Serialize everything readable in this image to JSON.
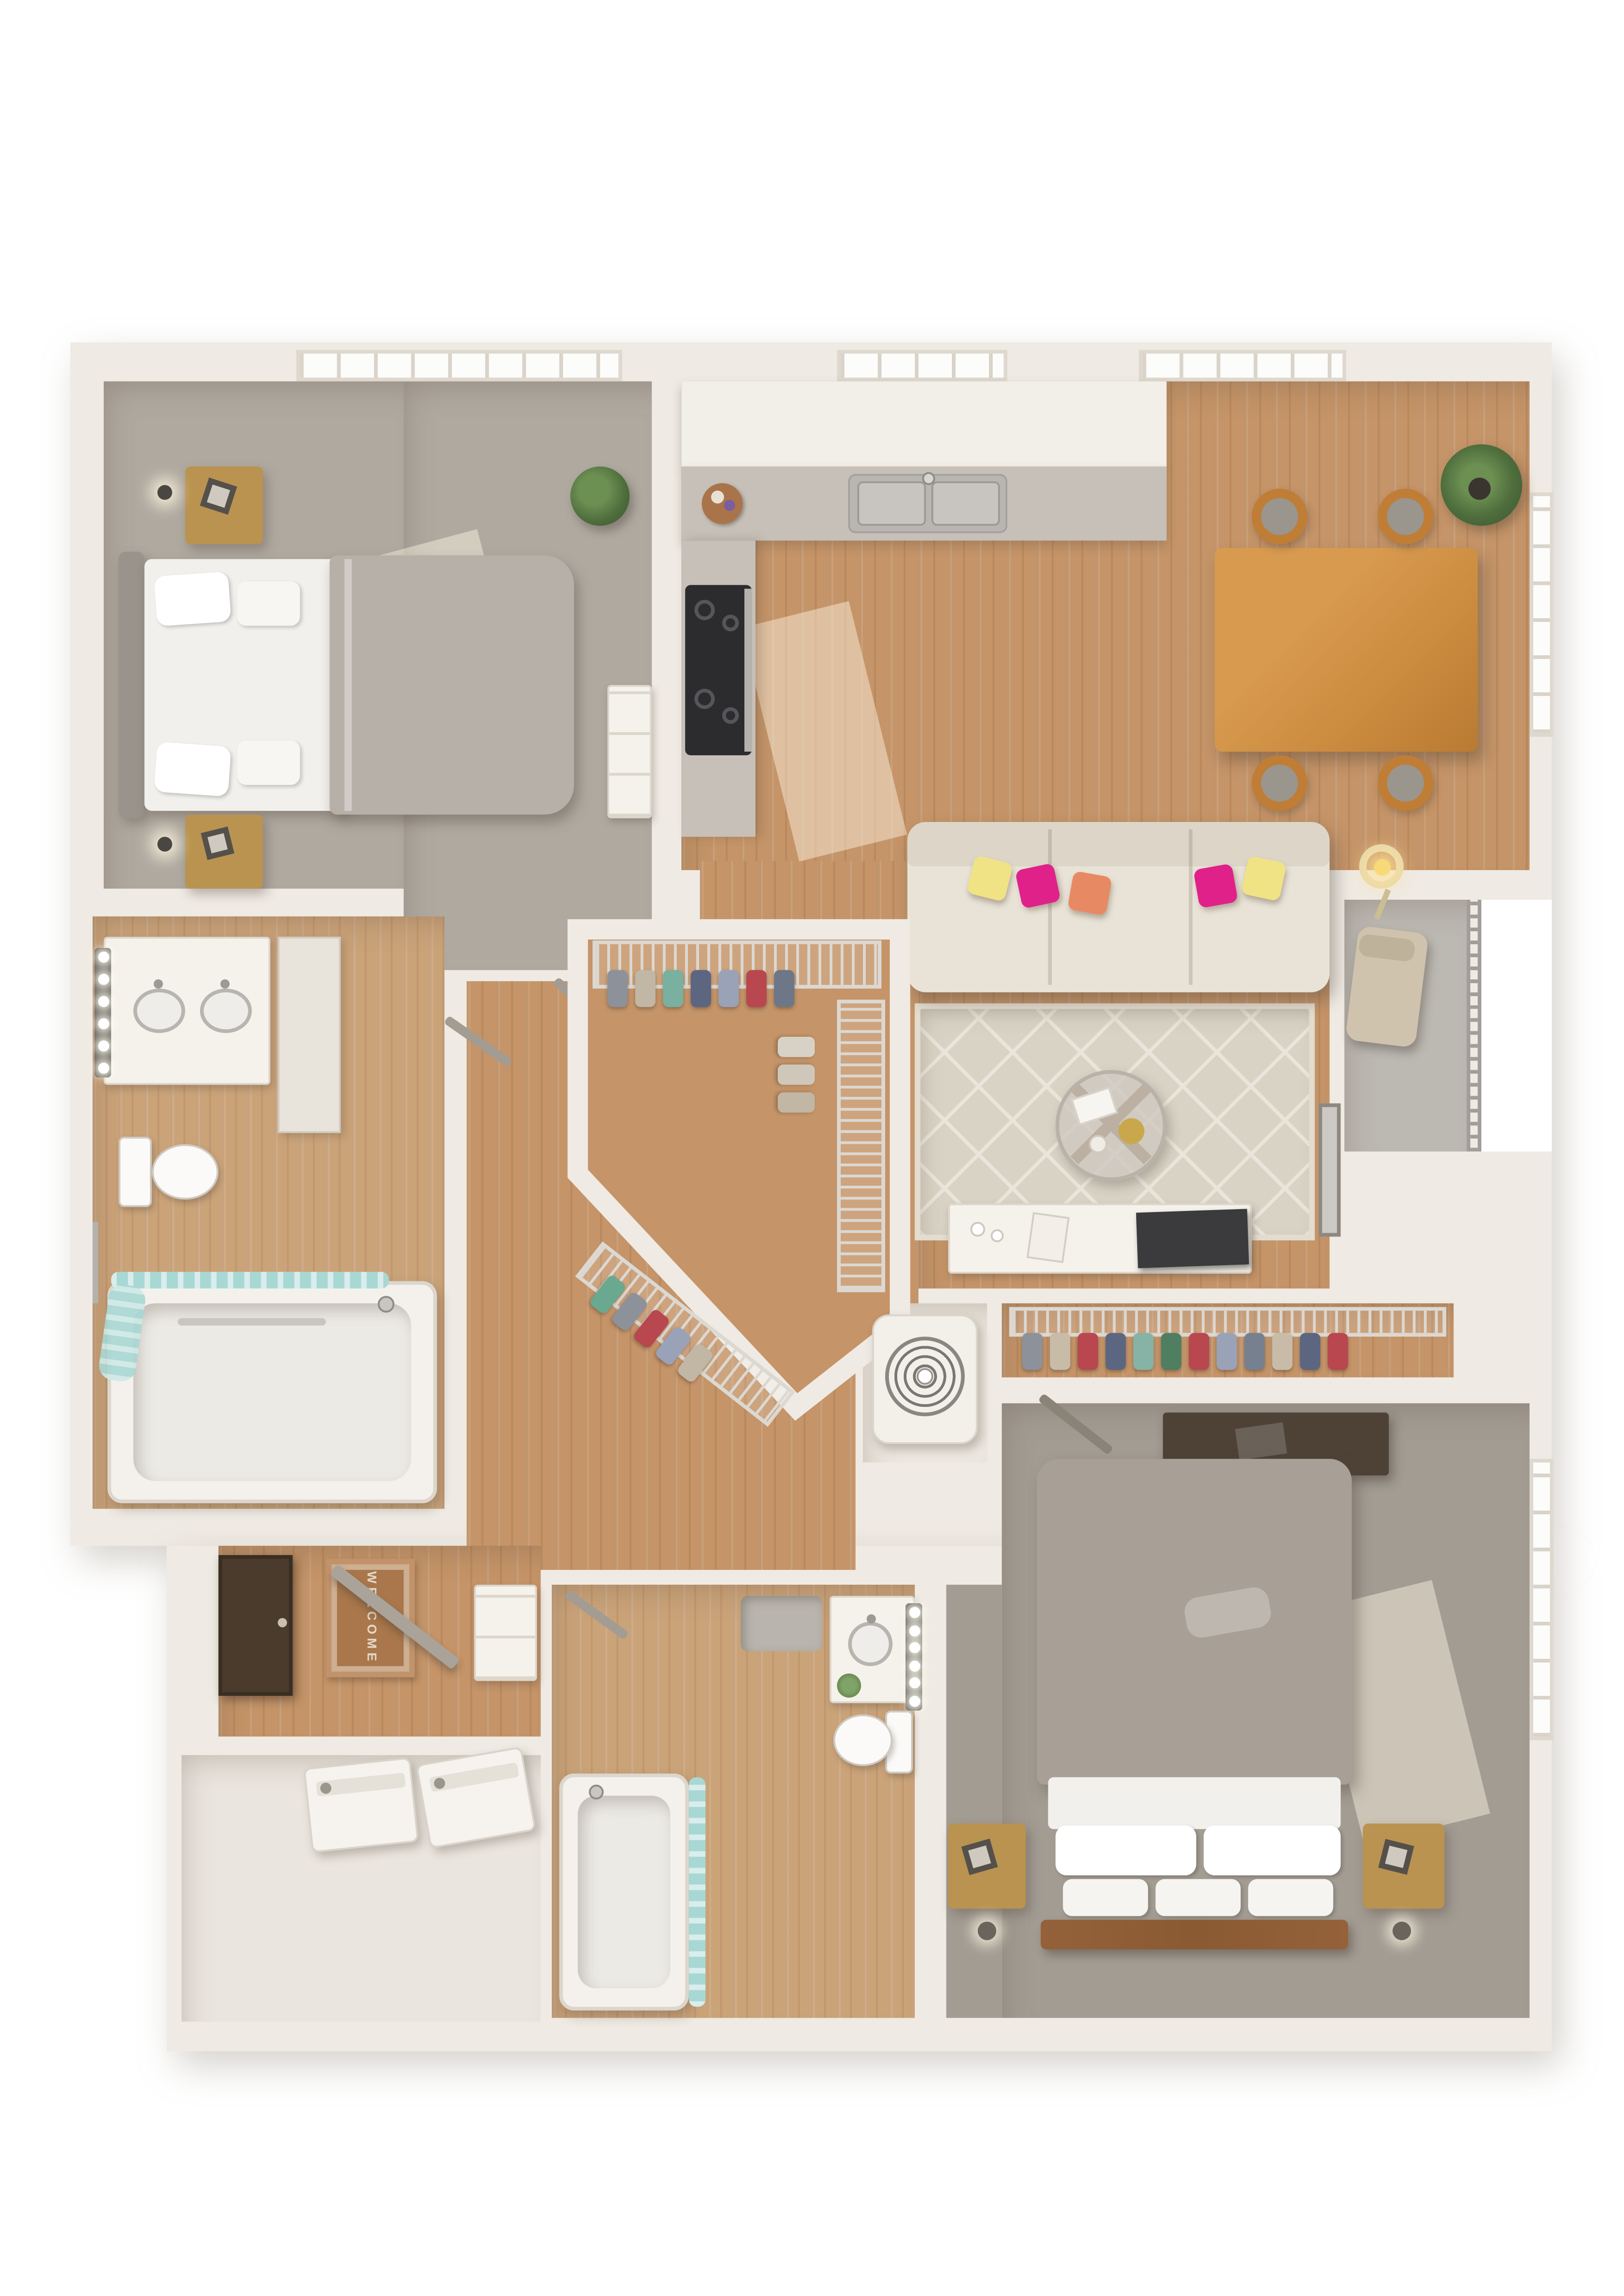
{
  "scene": {
    "description": "3D top-down dollhouse rendering of a two-bedroom, two-bathroom apartment floor plan",
    "entry_mat_text": "WELCOME"
  },
  "palette": {
    "page": "#ffffff",
    "wall": "#efeae3",
    "wallShade": "#e2dbd1",
    "wood": "#c59468",
    "bathFloor": "#cba379",
    "carpet1": "#b0a9a0",
    "carpet2": "#a39c93",
    "stone": "#c6c0b8",
    "cabinet": "#f2eee8",
    "white": "#f5f1eb",
    "sofa": "#e9e3d7",
    "rug": "#d9d3c5",
    "rugLine": "#eae5da",
    "pillowPink": "#e0218a",
    "pillowYellow": "#efe386",
    "pillowOrange": "#e78a63",
    "teal": "#a8d8d4",
    "plant": "#4f6f3d",
    "plantDark": "#3a5230",
    "concrete": "#bcb8b2",
    "railing": "#a19d98",
    "duvet1": "#b7b0a8",
    "duvet2": "#a89f96",
    "sheet": "#f2f0ec",
    "nightstand": "#b9934f",
    "tableWood": "#c98a3e",
    "chairWood": "#c07d35",
    "chairSeat": "#9a958d",
    "doorDark": "#4a3b2d",
    "doorGray": "#a39c93",
    "mat": "#a9774b",
    "matText": "#e4d8c8",
    "tv": "#3b3b3d",
    "steel": "#b9b6b2",
    "frameDark": "#55504a",
    "bedFrame2": "#8a5a33"
  },
  "clothes": {
    "walkin_top": [
      "#8d9199",
      "#c2b6a4",
      "#79b0a0",
      "#5c6680",
      "#9aa2b8",
      "#b8474f",
      "#6e7787"
    ],
    "walkin_right": [
      "#d8d2c6",
      "#cfc8ba",
      "#c2b6a4"
    ],
    "walkin_diag": [
      "#6aa88f",
      "#8d9199",
      "#b8474f",
      "#9aa2b8",
      "#c2b6a4"
    ],
    "hall_closet": [
      "#8d9199",
      "#c8bca8",
      "#b8474f",
      "#5c6680",
      "#86b3a5",
      "#4f7e60",
      "#b8474f",
      "#9aa2b8",
      "#77808f",
      "#c8bca8",
      "#5c6680",
      "#b8474f"
    ]
  },
  "rooms": [
    {
      "name": "bedroom-1",
      "floor": "carpet",
      "items": [
        "queen-bed",
        "white-pillows",
        "gray-duvet",
        "nightstand-left",
        "nightstand-right",
        "wall-sconces",
        "white-dresser",
        "potted-plant",
        "window"
      ]
    },
    {
      "name": "kitchen",
      "floor": "wood",
      "items": [
        "upper-cabinets",
        "stone-countertop",
        "double-basin-sink",
        "range-cooktop",
        "serving-board",
        "window"
      ]
    },
    {
      "name": "dining-area",
      "floor": "wood",
      "items": [
        "dining-table",
        "dining-chairs-x4",
        "palm-plant",
        "window-top",
        "window-right"
      ]
    },
    {
      "name": "living-room",
      "floor": "wood",
      "items": [
        "sofa",
        "throw-pillows-x5",
        "geometric-area-rug",
        "round-coffee-table",
        "floor-lamp",
        "media-console",
        "tv",
        "leaning-mirror"
      ]
    },
    {
      "name": "balcony",
      "floor": "concrete",
      "items": [
        "lounge-chair",
        "metal-railing"
      ]
    },
    {
      "name": "bathroom-1",
      "floor": "wood",
      "items": [
        "double-vanity",
        "vanity-lights",
        "linen-cabinet",
        "toilet",
        "bathtub",
        "teal-shower-curtain",
        "grab-bar"
      ]
    },
    {
      "name": "walk-in-closet",
      "floor": "wood",
      "items": [
        "wire-shelving",
        "hanging-clothes"
      ]
    },
    {
      "name": "hvac-closet",
      "items": [
        "air-handler-unit"
      ]
    },
    {
      "name": "hall-closet",
      "items": [
        "wire-shelf",
        "hanging-clothes"
      ]
    },
    {
      "name": "bedroom-2",
      "floor": "carpet",
      "items": [
        "queen-bed",
        "white-pillows",
        "taupe-duvet",
        "nightstand-left",
        "nightstand-right",
        "desk",
        "window"
      ]
    },
    {
      "name": "bathroom-2",
      "floor": "wood",
      "items": [
        "vanity",
        "round-sink",
        "vanity-lights",
        "toilet",
        "bathtub",
        "teal-shower-curtain",
        "bath-mat"
      ]
    },
    {
      "name": "entry",
      "floor": "wood",
      "items": [
        "welcome-mat",
        "front-door",
        "closet-door",
        "built-in-shelves"
      ]
    },
    {
      "name": "laundry-room",
      "items": [
        "washer",
        "dryer"
      ]
    }
  ]
}
